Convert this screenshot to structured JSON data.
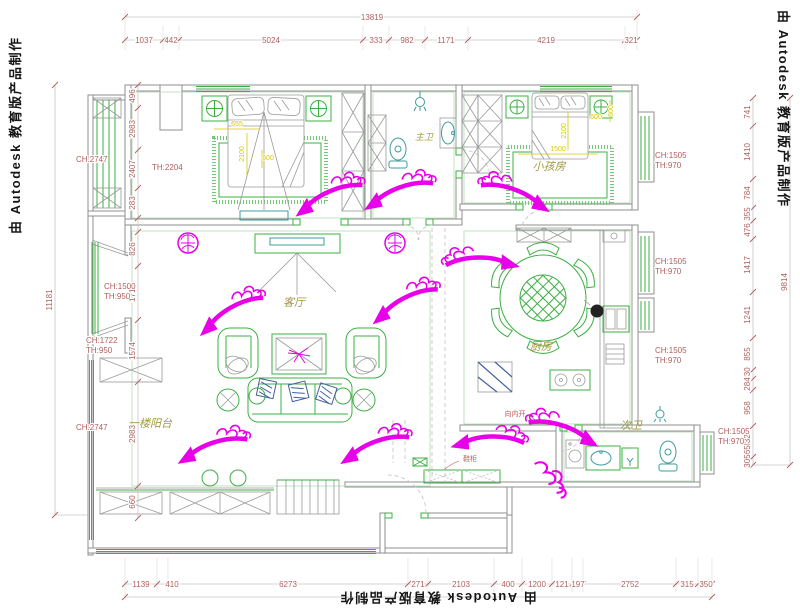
{
  "watermarks": {
    "left": "由 Autodesk 教育版产品制作",
    "right": "由 Autodesk 教育版产品制作",
    "bottom": "由 Autodesk 教育版产品制作"
  },
  "rooms": {
    "master_bath": "主卫",
    "kids_room": "小孩房",
    "living_room": "客厅",
    "kitchen": "厨房",
    "second_bath": "次卫",
    "balcony": "一楼阳台"
  },
  "heights": {
    "left_top": "CH:2747",
    "bay_ch": "CH:1500",
    "bay_th": "TH:950",
    "mid_ch": "CH:1722",
    "mid_th": "TH:950",
    "left_bottom": "CH:2747",
    "bedroom_th": "TH:2204",
    "right_ch": "CH:1505",
    "right_th": "TH:970"
  },
  "dims": {
    "top": {
      "overall": "13819",
      "segments": [
        "1037",
        "442",
        "5024",
        "333",
        "982",
        "1171",
        "4219",
        "321"
      ]
    },
    "left": {
      "overall": "11181",
      "segments": [
        "496",
        "2983",
        "2407",
        "283",
        "826",
        "1712",
        "1574",
        "2983",
        "660"
      ]
    },
    "right": {
      "overall": "9814",
      "segments": [
        "741",
        "1410",
        "784",
        "355",
        "476",
        "1417",
        "1241",
        "855",
        "230",
        "284",
        "958",
        "832",
        "365",
        "305"
      ]
    },
    "bottom": {
      "segments": [
        "1139",
        "410",
        "6273",
        "271",
        "2103",
        "400",
        "1200",
        "121",
        "197",
        "2752",
        "315",
        "350"
      ]
    }
  },
  "interior_dims": {
    "master": [
      "655",
      "2100",
      "600"
    ],
    "kids": [
      "1500",
      "2100",
      "600"
    ]
  },
  "notes": {
    "shoe_cabinet": "鞋柜",
    "door_note": "向内开"
  },
  "colors": {
    "dim_text": "#b0605f",
    "furniture_green": "#3cb043",
    "flow_arrow": "#e800e8",
    "interior_dim_yellow": "#d8c800",
    "room_label_olive": "#a09a3e"
  }
}
